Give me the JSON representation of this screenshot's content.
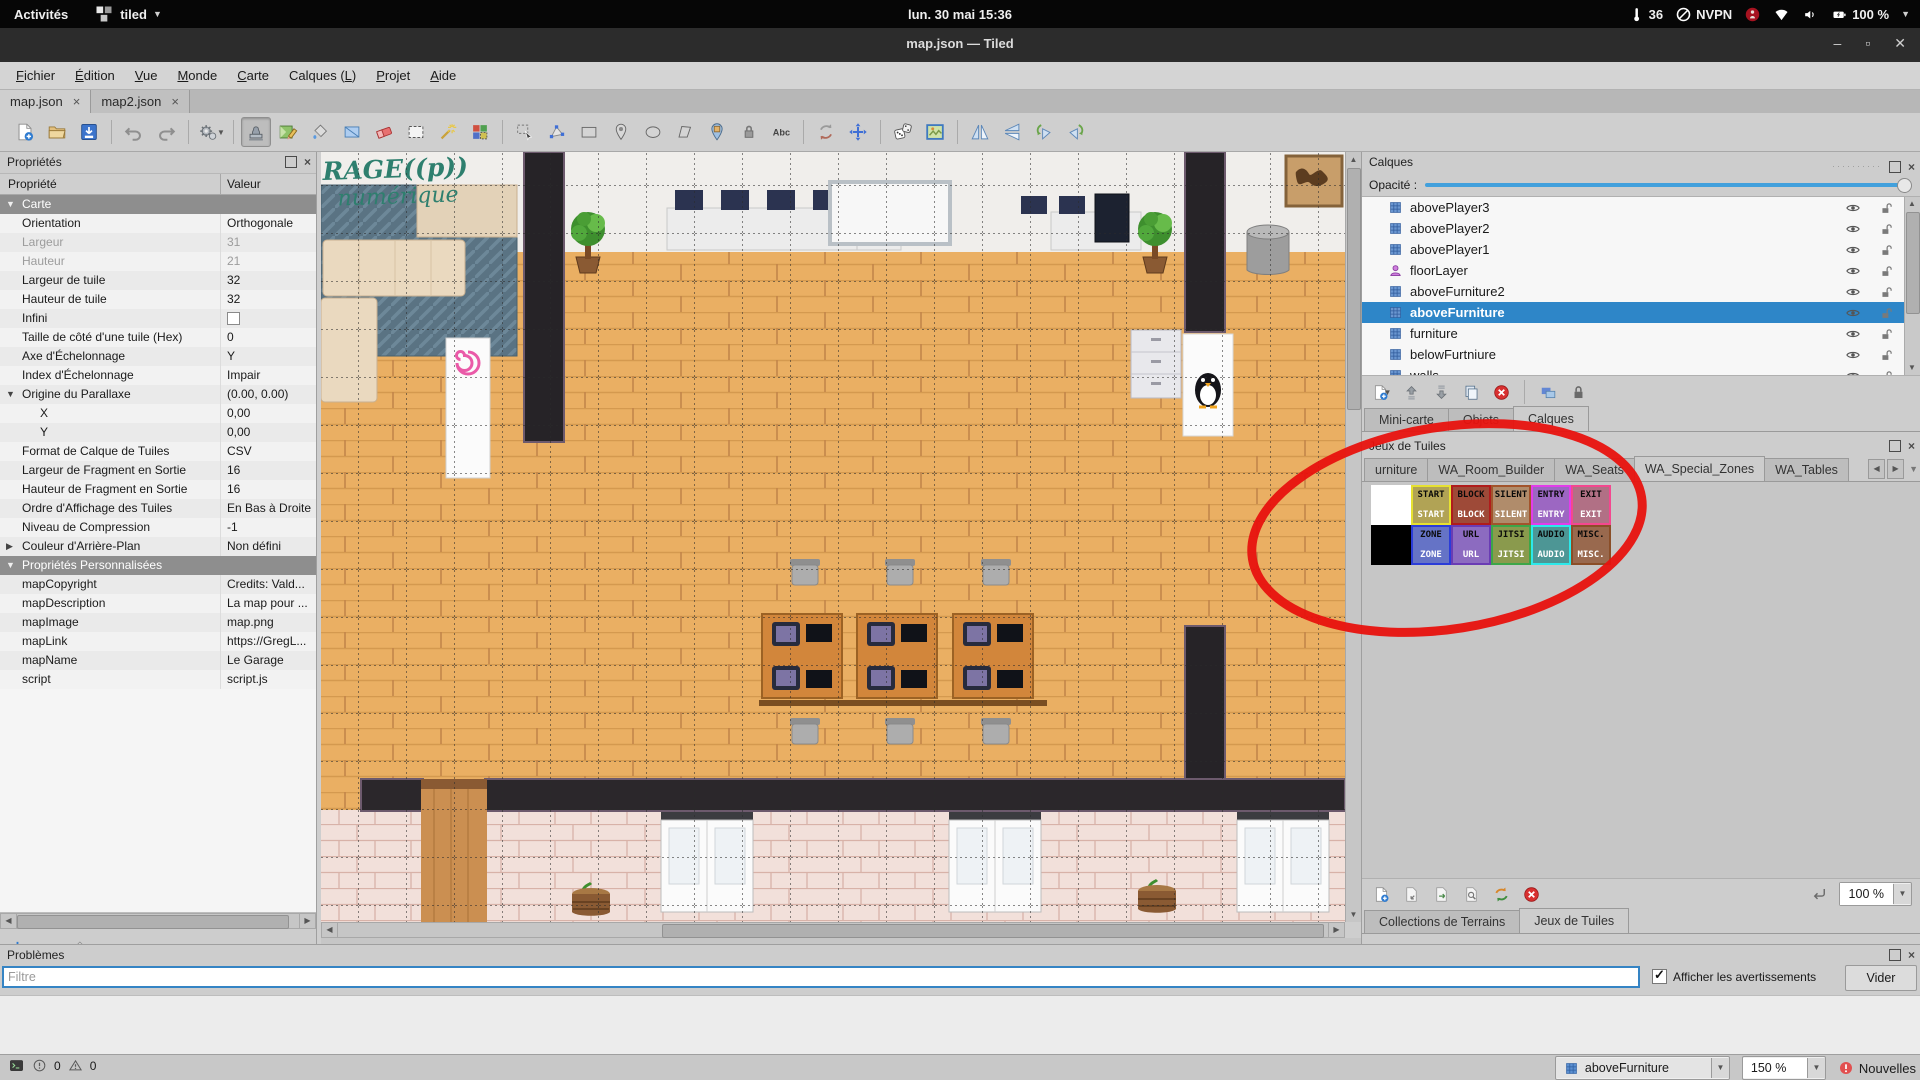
{
  "topbar": {
    "activities": "Activités",
    "app_name": "tiled",
    "clock": "lun. 30 mai 15:36",
    "temperature": "36",
    "vpn": "NVPN",
    "battery": "100 %",
    "tray_icons": [
      "thermometer",
      "vpn-slash",
      "app-badge",
      "wifi",
      "volume",
      "battery"
    ]
  },
  "titlebar": {
    "title": "map.json — Tiled",
    "minimize": "–",
    "maximize": "▫",
    "close": "✕"
  },
  "menubar": {
    "items": [
      {
        "label": "Fichier",
        "u": 0
      },
      {
        "label": "Édition",
        "u": 0
      },
      {
        "label": "Vue",
        "u": 0
      },
      {
        "label": "Monde",
        "u": 0
      },
      {
        "label": "Carte",
        "u": 0
      },
      {
        "label": "Calques (L)",
        "u": 9
      },
      {
        "label": "Projet",
        "u": 0
      },
      {
        "label": "Aide",
        "u": 0
      }
    ]
  },
  "doc_tabs": [
    {
      "label": "map.json",
      "active": true
    },
    {
      "label": "map2.json",
      "active": false
    }
  ],
  "toolbar": {
    "active_tool": "stamp-brush",
    "groups": [
      [
        "new-map",
        "open-map",
        "save-map"
      ],
      [
        "undo",
        "redo"
      ],
      [
        "commands"
      ],
      [
        "stamp-brush",
        "terrain-brush",
        "bucket-fill",
        "shape-fill",
        "eraser",
        "rect-select",
        "magic-wand",
        "same-tile-select"
      ],
      [
        "select-objects",
        "edit-polygons",
        "insert-rectangle",
        "insert-point",
        "insert-ellipse",
        "insert-polygon",
        "insert-tile",
        "insert-template",
        "insert-text"
      ],
      [
        "reload",
        "pan"
      ],
      [
        "random-mode",
        "map-image"
      ],
      [
        "flip-horizontal",
        "flip-vertical",
        "rotate-left",
        "rotate-right"
      ]
    ]
  },
  "properties_panel": {
    "title": "Propriétés",
    "columns": [
      "Propriété",
      "Valeur"
    ],
    "rows": [
      {
        "label": "Carte",
        "type": "group",
        "expanded": true
      },
      {
        "label": "Orientation",
        "value": "Orthogonale"
      },
      {
        "label": "Largeur",
        "value": "31",
        "muted": true
      },
      {
        "label": "Hauteur",
        "value": "21",
        "muted": true
      },
      {
        "label": "Largeur de tuile",
        "value": "32"
      },
      {
        "label": "Hauteur de tuile",
        "value": "32"
      },
      {
        "label": "Infini",
        "value": "",
        "checkbox": true
      },
      {
        "label": "Taille de côté d'une tuile (Hex)",
        "value": "0"
      },
      {
        "label": "Axe d'Échelonnage",
        "value": "Y"
      },
      {
        "label": "Index d'Échelonnage",
        "value": "Impair"
      },
      {
        "label": "Origine du Parallaxe",
        "value": "(0.00, 0.00)",
        "expander": "open"
      },
      {
        "label": "X",
        "value": "0,00",
        "indent": true
      },
      {
        "label": "Y",
        "value": "0,00",
        "indent": true
      },
      {
        "label": "Format de Calque de Tuiles",
        "value": "CSV"
      },
      {
        "label": "Largeur de Fragment en Sortie",
        "value": "16"
      },
      {
        "label": "Hauteur de Fragment en Sortie",
        "value": "16"
      },
      {
        "label": "Ordre d'Affichage des Tuiles",
        "value": "En Bas à Droite"
      },
      {
        "label": "Niveau de Compression",
        "value": "-1"
      },
      {
        "label": "Couleur d'Arrière-Plan",
        "value": "Non défini",
        "expander": "closed"
      },
      {
        "label": "Propriétés Personnalisées",
        "type": "group",
        "expanded": true
      },
      {
        "label": "mapCopyright",
        "value": "Credits: Vald..."
      },
      {
        "label": "mapDescription",
        "value": "La map pour ..."
      },
      {
        "label": "mapImage",
        "value": "map.png"
      },
      {
        "label": "mapLink",
        "value": "https://GregL..."
      },
      {
        "label": "mapName",
        "value": "Le Garage"
      },
      {
        "label": "script",
        "value": "script.js"
      }
    ]
  },
  "layers_panel": {
    "title": "Calques",
    "opacity_label": "Opacité :",
    "layers": [
      {
        "name": "abovePlayer3",
        "type": "tile"
      },
      {
        "name": "abovePlayer2",
        "type": "tile"
      },
      {
        "name": "abovePlayer1",
        "type": "tile"
      },
      {
        "name": "floorLayer",
        "type": "object"
      },
      {
        "name": "aboveFurniture2",
        "type": "tile"
      },
      {
        "name": "aboveFurniture",
        "type": "tile",
        "selected": true
      },
      {
        "name": "furniture",
        "type": "tile"
      },
      {
        "name": "belowFurtniure",
        "type": "tile"
      },
      {
        "name": "walls",
        "type": "tile"
      }
    ],
    "dock_tabs": [
      {
        "label": "Mini-carte",
        "active": false
      },
      {
        "label": "Objets",
        "active": false
      },
      {
        "label": "Calques",
        "active": true
      }
    ]
  },
  "tileset_panel": {
    "title": "Jeux de Tuiles",
    "tabs": [
      {
        "label": "urniture",
        "active": false
      },
      {
        "label": "WA_Room_Builder",
        "active": false
      },
      {
        "label": "WA_Seats",
        "active": false
      },
      {
        "label": "WA_Special_Zones",
        "active": true
      },
      {
        "label": "WA_Tables",
        "active": false
      }
    ],
    "tiles": [
      [
        {
          "label": "",
          "bg": "#ffffff",
          "border": "#ffffff"
        },
        {
          "label": "START",
          "bg": "#b1a355",
          "border": "#e6e131"
        },
        {
          "label": "BLOCK",
          "bg": "#9e4a38",
          "border": "#b01c1c"
        },
        {
          "label": "SILENT",
          "bg": "#b08c6b",
          "border": "#a2542c"
        },
        {
          "label": "ENTRY",
          "bg": "#9c67c2",
          "border": "#e23de9"
        },
        {
          "label": "EXIT",
          "bg": "#b17085",
          "border": "#f4478f"
        }
      ],
      [
        {
          "label": "",
          "bg": "#000000",
          "border": "#000000"
        },
        {
          "label": "ZONE",
          "bg": "#6573c6",
          "border": "#2b3cd8"
        },
        {
          "label": "URL",
          "bg": "#8c6bc0",
          "border": "#6a3cb4"
        },
        {
          "label": "JITSI",
          "bg": "#8a9a4d",
          "border": "#3da649"
        },
        {
          "label": "AUDIO",
          "bg": "#4d9695",
          "border": "#2ce9ea"
        },
        {
          "label": "MISC.",
          "bg": "#99694e",
          "border": "#8a4e28"
        }
      ]
    ],
    "zoom": "100 %",
    "bottom_tabs": [
      {
        "label": "Collections de Terrains",
        "active": false
      },
      {
        "label": "Jeux de Tuiles",
        "active": true
      }
    ]
  },
  "problems_panel": {
    "title": "Problèmes",
    "filter_placeholder": "Filtre",
    "warnings_label": "Afficher les avertissements",
    "warnings_checked": true,
    "clear_button": "Vider"
  },
  "statusbar": {
    "error_count": "0",
    "warning_count": "0",
    "current_layer": "aboveFurniture",
    "zoom": "150 %",
    "news_label": "Nouvelles"
  },
  "map_view": {
    "wall_text_line1": "RAGE((p))",
    "wall_text_line2": "numérique"
  },
  "annotation": {
    "color": "#e8120e"
  }
}
